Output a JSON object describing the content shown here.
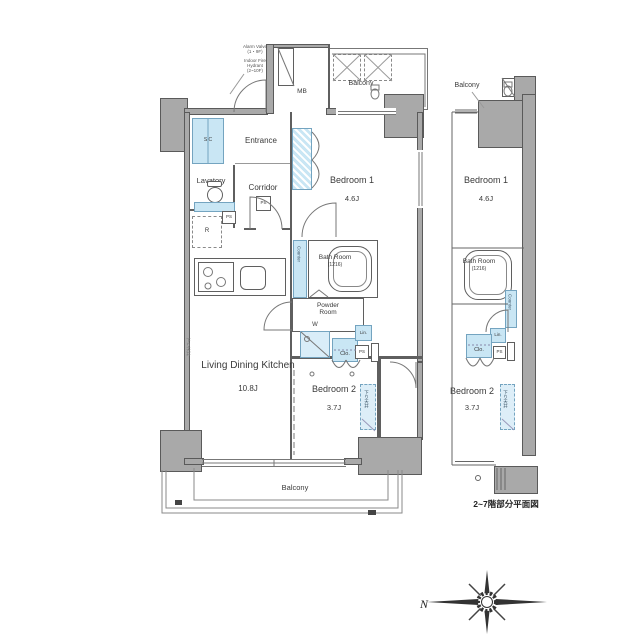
{
  "main_plan": {
    "notes": {
      "alarm_valve": "Alarm Valve\n(1・9F)",
      "fire_hydrant": "Indoor Fire\nHydrant\n(2~10F)"
    },
    "rooms": {
      "balcony_top": "Balcony",
      "entrance": "Entrance",
      "corridor": "Corridor",
      "lavatory": "Lavatory",
      "bedroom1_name": "Bedroom 1",
      "bedroom1_size": "4.6J",
      "bathroom_name": "Bath Room",
      "bathroom_size": "(1216)",
      "powder_room": "Powder\nRoom",
      "ldk_name": "Living Dining Kitchen",
      "ldk_size": "10.8J",
      "bedroom2_name": "Bedroom 2",
      "bedroom2_size": "3.7J",
      "balcony_bottom": "Balcony"
    },
    "fixtures": {
      "mb": "MB",
      "sic": "SIC",
      "ps": "PS",
      "fridge": "R",
      "washer": "W",
      "closet": "Clo.",
      "linen": "Lin.",
      "counter": "Counter",
      "lowered_ceiling": "下り天井"
    }
  },
  "sub_plan": {
    "rooms": {
      "balcony": "Balcony",
      "bedroom1_name": "Bedroom 1",
      "bedroom1_size": "4.6J",
      "bathroom_name": "Bath Room",
      "bathroom_size": "(1216)",
      "bedroom2_name": "Bedroom 2",
      "bedroom2_size": "3.7J"
    },
    "fixtures": {
      "closet": "Clo.",
      "linen": "Lin.",
      "ps": "PS",
      "counter": "Counter",
      "lowered_ceiling": "下り天井"
    },
    "caption": "2~7階部分平面図"
  },
  "compass": {
    "north": "N"
  }
}
